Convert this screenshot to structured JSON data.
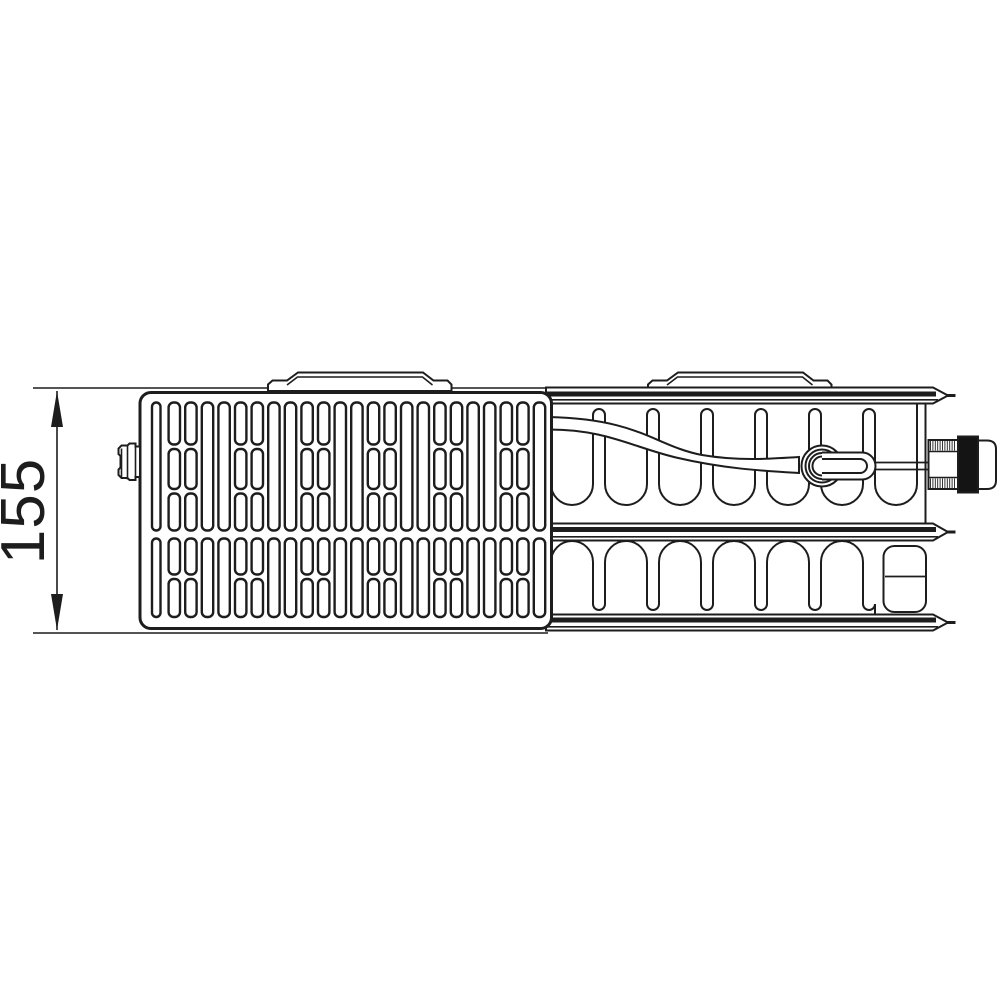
{
  "dimension": {
    "value": "155"
  },
  "colors": {
    "line": "#1d1d1d",
    "background": "#ffffff",
    "valve_collar": "#141414"
  },
  "components": {
    "drawing": "radiator-top-view-technical-drawing",
    "front": "front-grille-panel",
    "rear": "rear-panel-and-convector",
    "valve": "integrated-valve-connection",
    "brackets": "top-mounting-brackets",
    "plug": "left-end-plug"
  },
  "grille": {
    "columns": 24,
    "x_start": 152,
    "pitch": 16.6,
    "slot_width": 11.4,
    "first_slot_width": 8.5,
    "corner_radius": 5,
    "segmented_modulo": 4,
    "top_band": {
      "full": [
        402.5,
        128
      ],
      "segments": [
        [
          402.5,
          42
        ],
        [
          449,
          40
        ],
        [
          493.5,
          37
        ]
      ]
    },
    "bottom_band": {
      "full": [
        538.5,
        78.5
      ],
      "segments": [
        [
          538.5,
          36
        ],
        [
          579,
          38
        ]
      ]
    }
  },
  "thread_hatch": {
    "x0": 930.5,
    "x1": 956.5,
    "step": 2.4,
    "bands": [
      [
        441,
        450.5
      ],
      [
        478.5,
        488
      ]
    ]
  }
}
